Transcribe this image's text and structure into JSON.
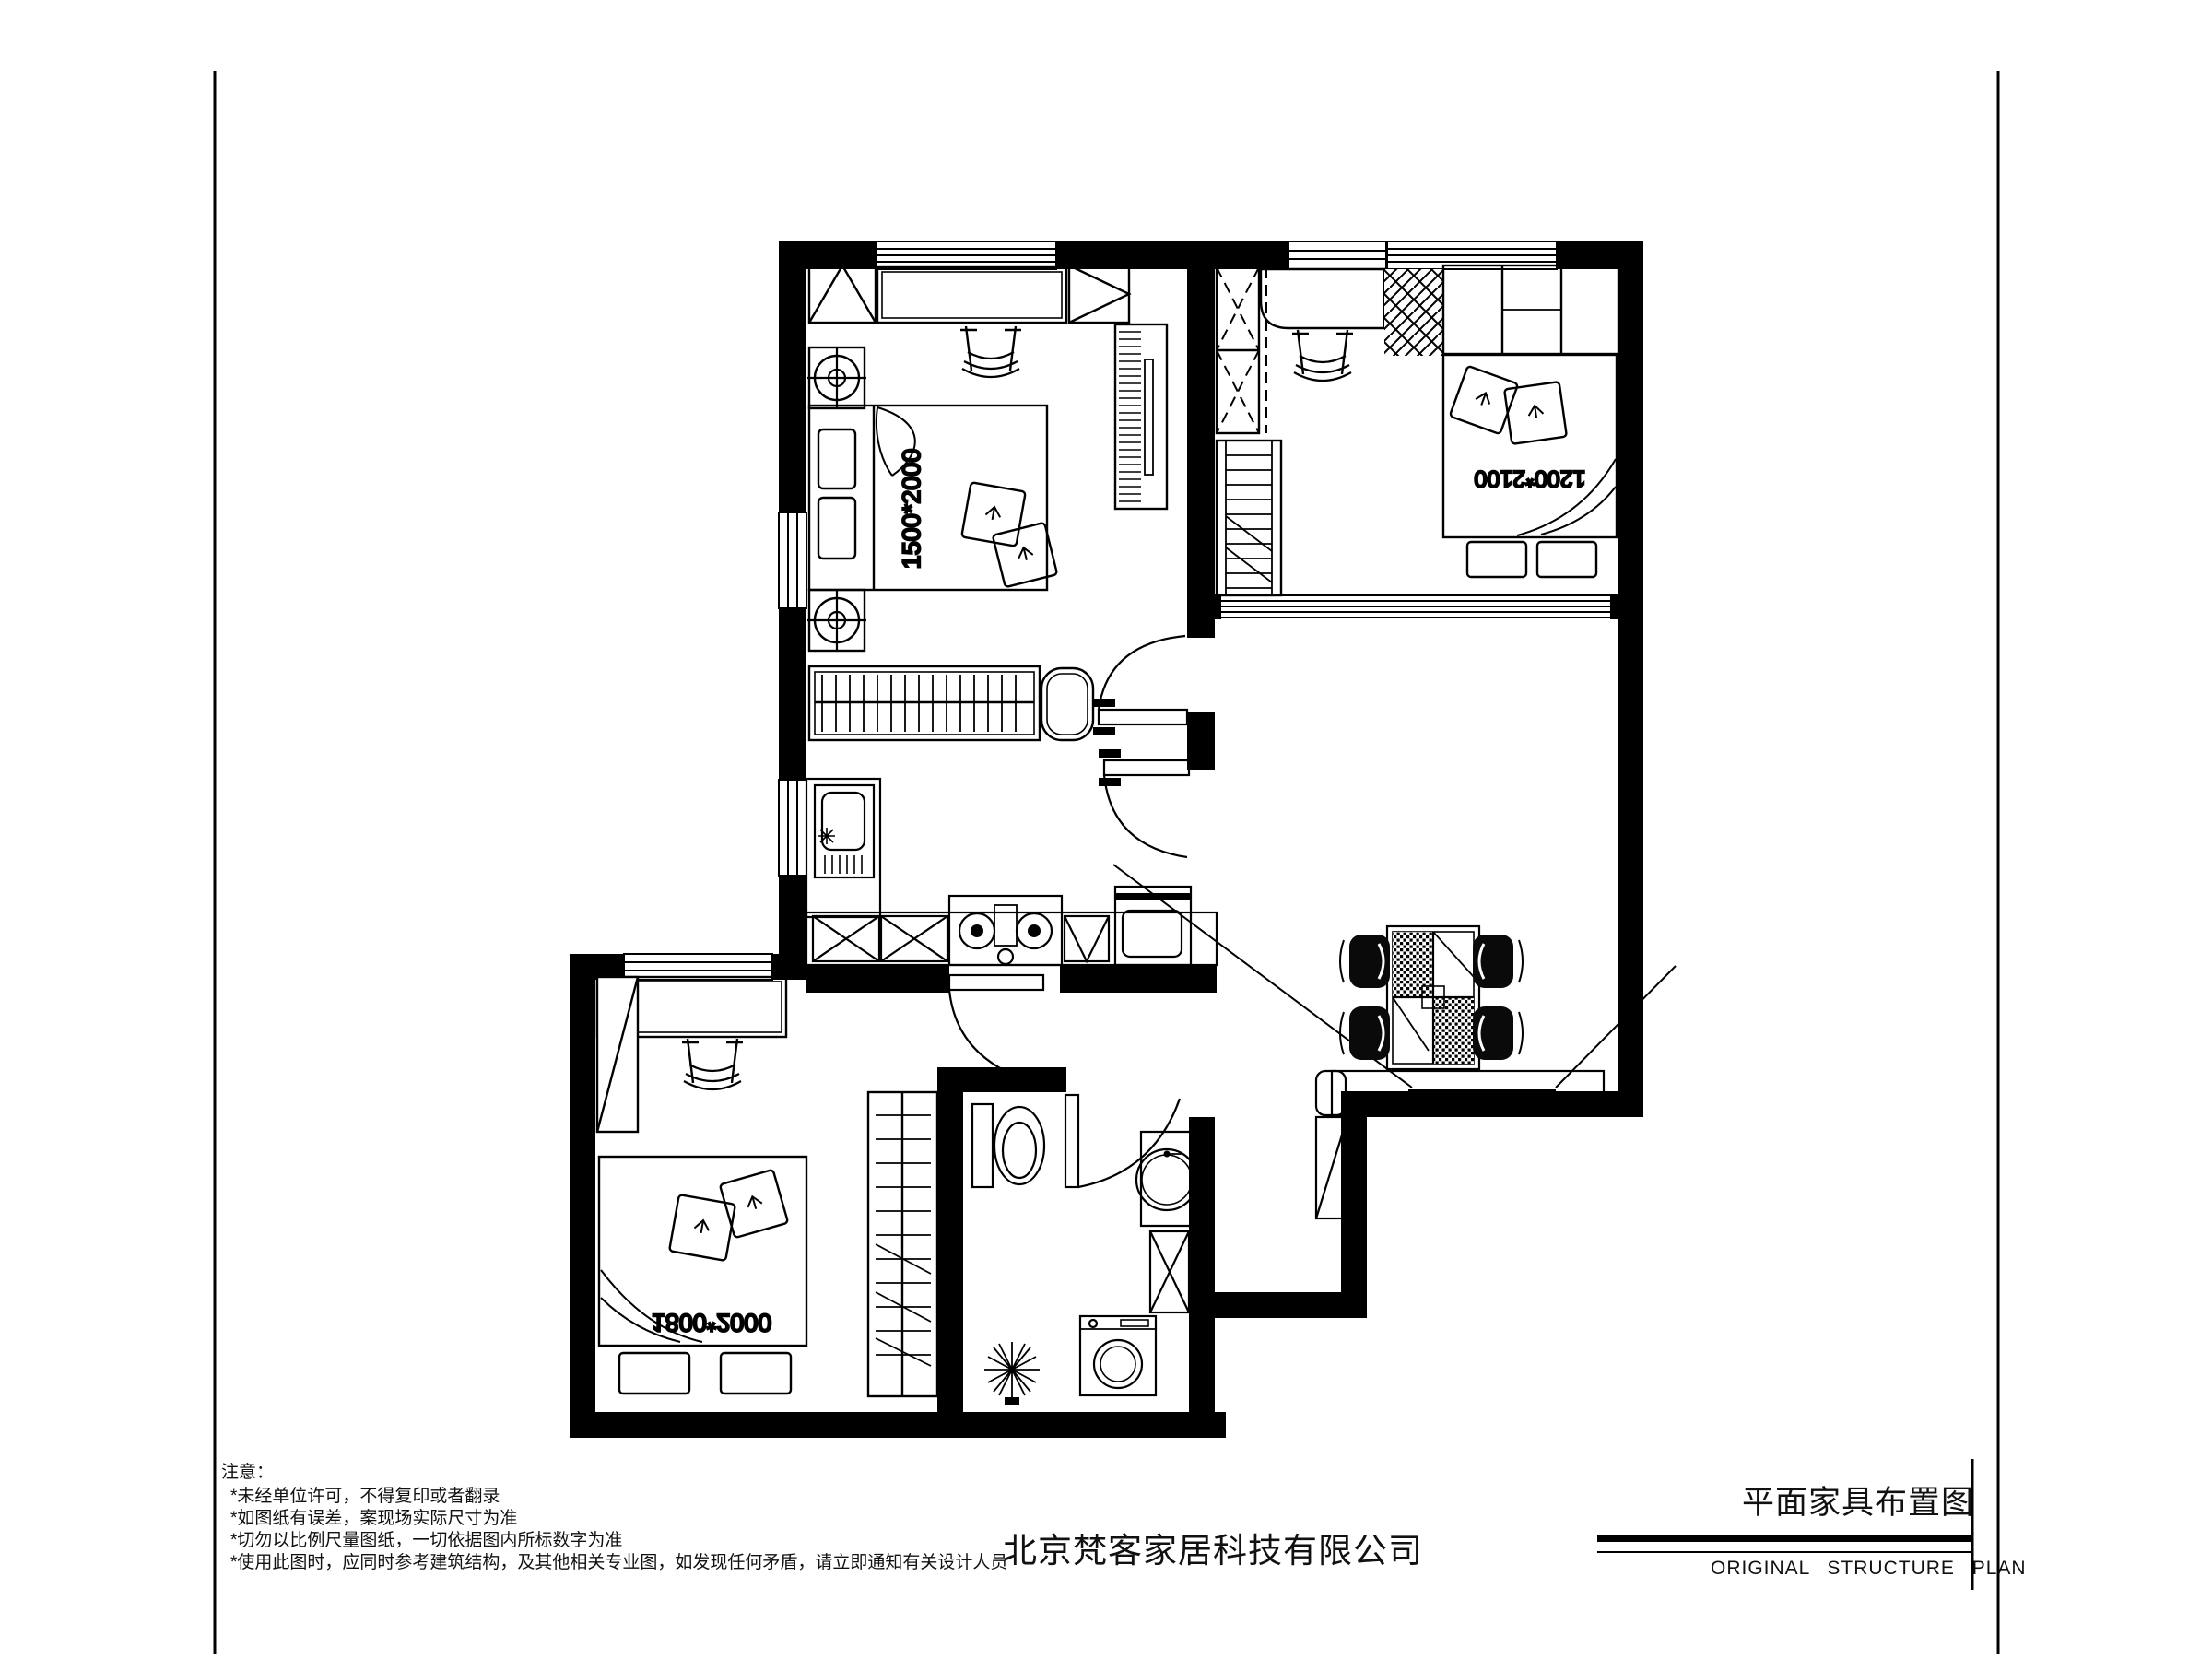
{
  "colors": {
    "ink": "#000000",
    "paper": "#ffffff"
  },
  "notes": {
    "title": "注意：",
    "items": [
      "*未经单位许可，不得复印或者翻录",
      "*如图纸有误差，案现场实际尺寸为准",
      "*切勿以比例尺量图纸，一切依据图内所标数字为准",
      "*使用此图时，应同时参考建筑结构，及其他相关专业图，如发现任何矛盾，请立即通知有关设计人员"
    ]
  },
  "footer": {
    "company_name": "北京梵客家居科技有限公司"
  },
  "title_block": {
    "title_cn": "平面家具布置图",
    "title_en": "ORIGINAL  STRUCTURE  PLAN"
  },
  "plan": {
    "bed_labels": {
      "bedroom1": "1500*2000",
      "bedroom2": "1200*2100",
      "bedroom3": "1800*2000"
    },
    "furniture_icons": [
      "wardrobe-icon",
      "desk-icon",
      "chair-icon",
      "double-bed-icon",
      "pillow-icon",
      "nightstand-lamp-icon",
      "radiator-bench-icon",
      "kitchen-sink-icon",
      "gas-stove-icon",
      "oven-icon",
      "toilet-icon",
      "washbasin-icon",
      "washing-machine-icon",
      "plant-icon",
      "dining-table-icon",
      "dining-chair-icon",
      "tv-sideboard-icon",
      "door-swing-icon",
      "window-icon"
    ]
  }
}
